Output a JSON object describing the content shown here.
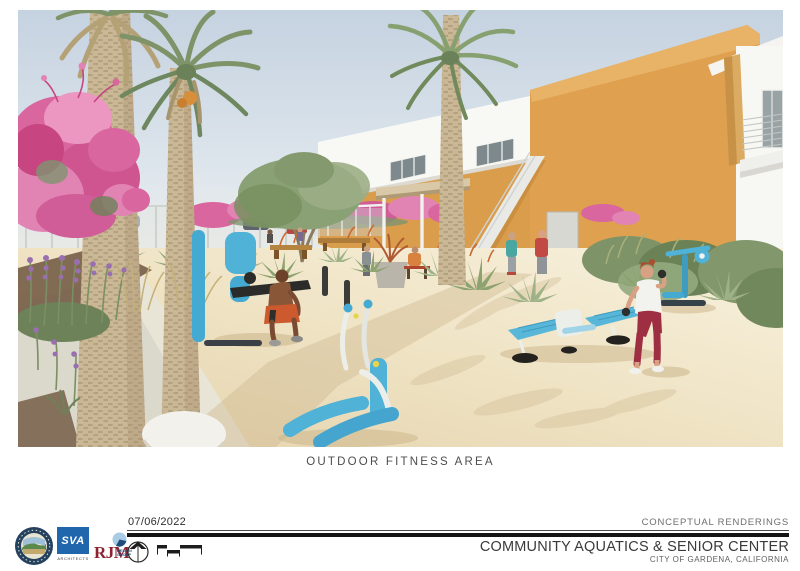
{
  "page": {
    "caption": "OUTDOOR FITNESS AREA"
  },
  "footer": {
    "date": "07/06/2022",
    "series_label": "CONCEPTUAL RENDERINGS",
    "project_title": "COMMUNITY AQUATICS & SENIOR CENTER",
    "project_location": "CITY OF GARDENA, CALIFORNIA",
    "logos": [
      {
        "id": "city-of-gardena-seal"
      },
      {
        "id": "sva-architects",
        "text": "SVA",
        "subtext": "ARCHITECTS"
      },
      {
        "id": "rjm-design-group",
        "text": "RJM",
        "subtext": "DESIGN GROUP"
      }
    ]
  },
  "rendering": {
    "alt": "Conceptual rendering of an outdoor fitness area: sandy decomposed-granite plaza with blue outdoor exercise equipment (lat pulldown, elliptical, twin sit-up benches, upright trainer), a man exercising and a woman lifting dumbbells, palm trees, pink bougainvillea, purple flower spikes, agave plantings, picnic benches, and an orange-and-white senior center building with exterior stair in the background",
    "colors": {
      "sky": "#c9d5e2",
      "building_orange": "#dfa14f",
      "building_white": "#f8f8f5",
      "equipment_blue": "#4fb2d6",
      "bougainvillea_pink": "#d9669e",
      "sand": "#efe3c6"
    }
  }
}
